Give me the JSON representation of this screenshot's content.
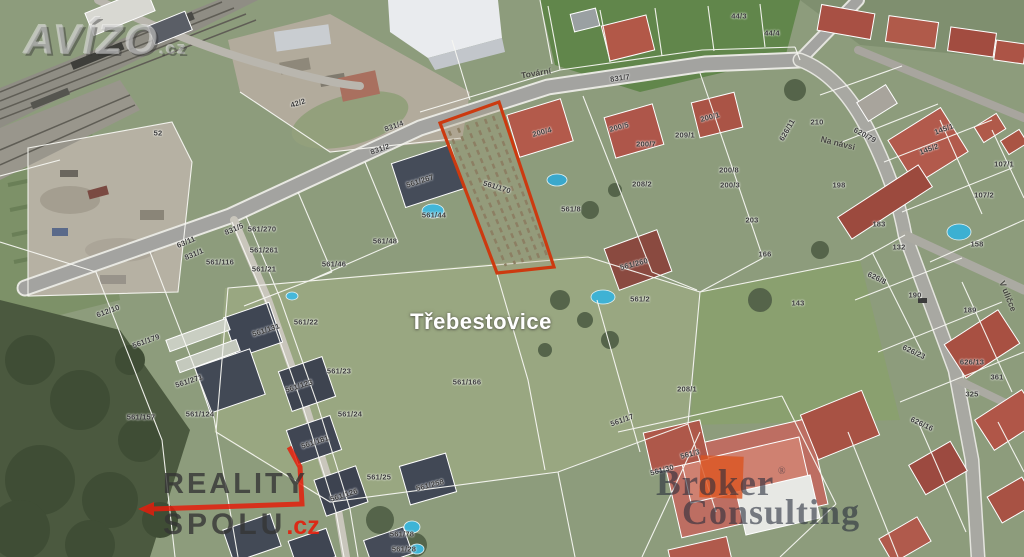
{
  "map": {
    "place_label": "Třebestovice",
    "highlighted_parcel": {
      "number": "561/170"
    },
    "street_labels": [
      {
        "text": "Tovární",
        "x": 536,
        "y": 73,
        "rot": -9
      },
      {
        "text": "Na návsi",
        "x": 838,
        "y": 143,
        "rot": 14
      },
      {
        "text": "V uličce",
        "x": 1008,
        "y": 296,
        "rot": 68
      }
    ],
    "parcel_labels": [
      {
        "text": "52",
        "x": 158,
        "y": 133
      },
      {
        "text": "42/2",
        "x": 298,
        "y": 103,
        "rot": -18
      },
      {
        "text": "831/4",
        "x": 394,
        "y": 126,
        "rot": -20
      },
      {
        "text": "831/2",
        "x": 380,
        "y": 149,
        "rot": -20
      },
      {
        "text": "831/7",
        "x": 620,
        "y": 78,
        "rot": -8
      },
      {
        "text": "831/5",
        "x": 234,
        "y": 229,
        "rot": -23
      },
      {
        "text": "44/3",
        "x": 739,
        "y": 16
      },
      {
        "text": "44/4",
        "x": 772,
        "y": 33
      },
      {
        "text": "63/11",
        "x": 186,
        "y": 242,
        "rot": -23
      },
      {
        "text": "831/1",
        "x": 194,
        "y": 254,
        "rot": -23
      },
      {
        "text": "561/270",
        "x": 262,
        "y": 229
      },
      {
        "text": "561/261",
        "x": 264,
        "y": 250
      },
      {
        "text": "561/116",
        "x": 220,
        "y": 262
      },
      {
        "text": "561/21",
        "x": 264,
        "y": 269
      },
      {
        "text": "561/46",
        "x": 334,
        "y": 264
      },
      {
        "text": "561/48",
        "x": 385,
        "y": 241
      },
      {
        "text": "561/267",
        "x": 420,
        "y": 181,
        "rot": -18
      },
      {
        "text": "561/44",
        "x": 434,
        "y": 215
      },
      {
        "text": "561/170",
        "x": 497,
        "y": 187,
        "rot": 17
      },
      {
        "text": "200/4",
        "x": 542,
        "y": 132,
        "rot": -15
      },
      {
        "text": "200/5",
        "x": 619,
        "y": 127,
        "rot": -15
      },
      {
        "text": "200/7",
        "x": 646,
        "y": 144
      },
      {
        "text": "209/1",
        "x": 685,
        "y": 135
      },
      {
        "text": "200/1",
        "x": 710,
        "y": 117,
        "rot": -15
      },
      {
        "text": "208/2",
        "x": 642,
        "y": 184
      },
      {
        "text": "200/8",
        "x": 729,
        "y": 170
      },
      {
        "text": "200/3",
        "x": 730,
        "y": 185
      },
      {
        "text": "561/8",
        "x": 571,
        "y": 209
      },
      {
        "text": "203",
        "x": 752,
        "y": 220
      },
      {
        "text": "612/10",
        "x": 108,
        "y": 311,
        "rot": -20
      },
      {
        "text": "561/179",
        "x": 146,
        "y": 341,
        "rot": -20
      },
      {
        "text": "561/131",
        "x": 266,
        "y": 330,
        "rot": -18
      },
      {
        "text": "561/22",
        "x": 306,
        "y": 322
      },
      {
        "text": "561/23",
        "x": 339,
        "y": 371
      },
      {
        "text": "561/271",
        "x": 189,
        "y": 381,
        "rot": -18
      },
      {
        "text": "561/123",
        "x": 299,
        "y": 386,
        "rot": -18
      },
      {
        "text": "561/157",
        "x": 141,
        "y": 417
      },
      {
        "text": "561/124",
        "x": 200,
        "y": 414
      },
      {
        "text": "561/24",
        "x": 350,
        "y": 414
      },
      {
        "text": "561/181",
        "x": 315,
        "y": 442,
        "rot": -18
      },
      {
        "text": "561/25",
        "x": 379,
        "y": 477
      },
      {
        "text": "561/126",
        "x": 344,
        "y": 495,
        "rot": -18
      },
      {
        "text": "561/258",
        "x": 430,
        "y": 485,
        "rot": -15
      },
      {
        "text": "561/78",
        "x": 402,
        "y": 534
      },
      {
        "text": "561/28",
        "x": 404,
        "y": 549
      },
      {
        "text": "561/166",
        "x": 467,
        "y": 382
      },
      {
        "text": "561/2",
        "x": 640,
        "y": 299
      },
      {
        "text": "561/260",
        "x": 634,
        "y": 264,
        "rot": -15
      },
      {
        "text": "561/17",
        "x": 622,
        "y": 420,
        "rot": -20
      },
      {
        "text": "208/1",
        "x": 687,
        "y": 389
      },
      {
        "text": "561/3",
        "x": 690,
        "y": 454,
        "rot": -15
      },
      {
        "text": "561/30",
        "x": 662,
        "y": 470,
        "rot": -15
      },
      {
        "text": "166",
        "x": 765,
        "y": 254
      },
      {
        "text": "210",
        "x": 817,
        "y": 122
      },
      {
        "text": "626/11",
        "x": 787,
        "y": 130,
        "rot": -60
      },
      {
        "text": "620/79",
        "x": 865,
        "y": 135,
        "rot": 28
      },
      {
        "text": "145/1",
        "x": 944,
        "y": 129,
        "rot": -20
      },
      {
        "text": "145/2",
        "x": 929,
        "y": 149,
        "rot": -20
      },
      {
        "text": "198",
        "x": 839,
        "y": 185
      },
      {
        "text": "107/1",
        "x": 1004,
        "y": 164
      },
      {
        "text": "107/2",
        "x": 984,
        "y": 195
      },
      {
        "text": "183",
        "x": 879,
        "y": 224
      },
      {
        "text": "132",
        "x": 899,
        "y": 247
      },
      {
        "text": "158",
        "x": 977,
        "y": 244
      },
      {
        "text": "143",
        "x": 798,
        "y": 303
      },
      {
        "text": "626/8",
        "x": 877,
        "y": 278,
        "rot": 25
      },
      {
        "text": "190",
        "x": 915,
        "y": 295
      },
      {
        "text": "189",
        "x": 970,
        "y": 310
      },
      {
        "text": "626/23",
        "x": 914,
        "y": 352,
        "rot": 25
      },
      {
        "text": "626/13",
        "x": 972,
        "y": 362
      },
      {
        "text": "361",
        "x": 997,
        "y": 377
      },
      {
        "text": "325",
        "x": 972,
        "y": 394
      },
      {
        "text": "626/16",
        "x": 922,
        "y": 424,
        "rot": 25
      }
    ]
  },
  "watermarks": {
    "avizo": {
      "name": "AVÍZO",
      "tld": ".cz"
    },
    "reality_spolu": {
      "line1": "REALITY",
      "line2": "SPOLU",
      "tld": ".cz"
    },
    "broker_consulting": {
      "word1": "Broker",
      "word2": "Consulting",
      "registered": "®"
    }
  },
  "colors": {
    "parcel_highlight": "#cc3a10",
    "reality_red": "#e41e0c",
    "broker_orange": "#db5420",
    "map_label_ink": "#3c3c3c",
    "place_label_color": "#ffffff"
  }
}
